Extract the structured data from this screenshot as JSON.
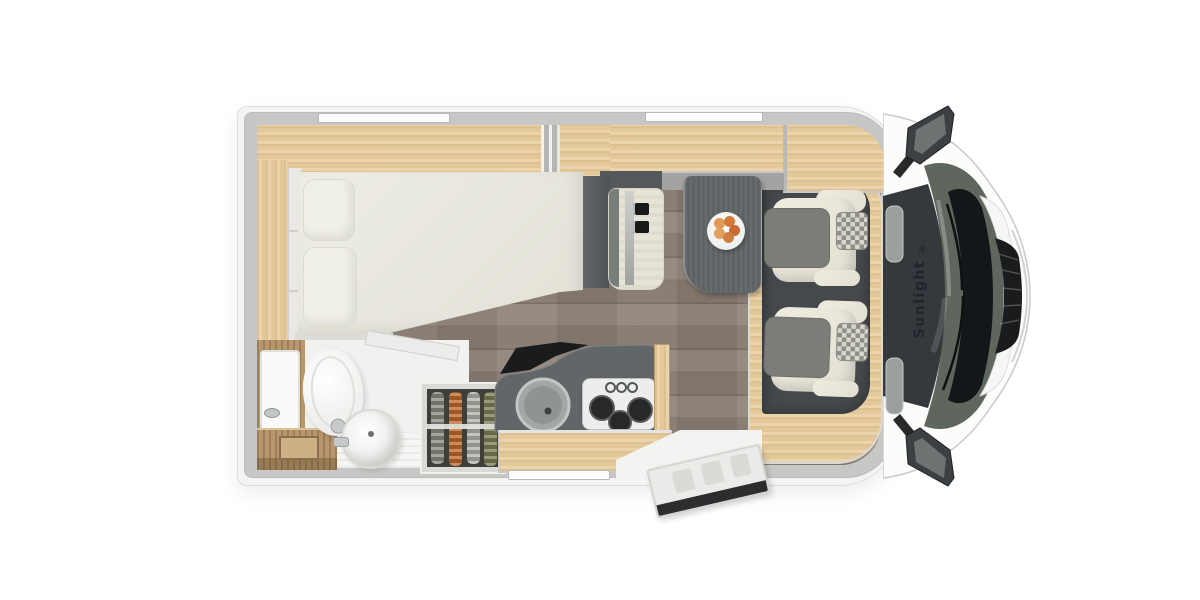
{
  "image": {
    "type": "motorhome-floor-plan-top-view",
    "width": 1200,
    "height": 600
  },
  "branding": {
    "name": "Sunlight",
    "logo_glyph": "✳"
  },
  "features": {
    "windows_top": 2,
    "windows_bottom": 1,
    "cab_seats": 2,
    "travel_bench_belts": 2,
    "stove_burners": 3,
    "hanging_garments": 4,
    "pillows": 2
  },
  "palette": {
    "bg": "#ffffff",
    "wall": "#c7c7c5",
    "body": "#f4f4f2",
    "wood": "#e9cfa2",
    "vanity_wood": "#b08e63",
    "floor": "#8d8076",
    "dark_unit": "#585c5e",
    "table": "#5e6366",
    "counter": "#616668",
    "mattress": "#eae8df",
    "seat_cream": "#e7e4d7",
    "seat_gray": "#7b7d76",
    "cab_floor": "#45494b",
    "glass": "#5e665e",
    "cowl": "#141719",
    "grille": "#191b1c",
    "mirror": "#3c4042",
    "brand_text": "#20242e",
    "cloth_gray": "#8b8d80",
    "cloth_orange": "#c06a2c",
    "cloth_light": "#b3b2aa",
    "cloth_olive": "#7e7f55",
    "fruit_orange": "#d4813f"
  }
}
